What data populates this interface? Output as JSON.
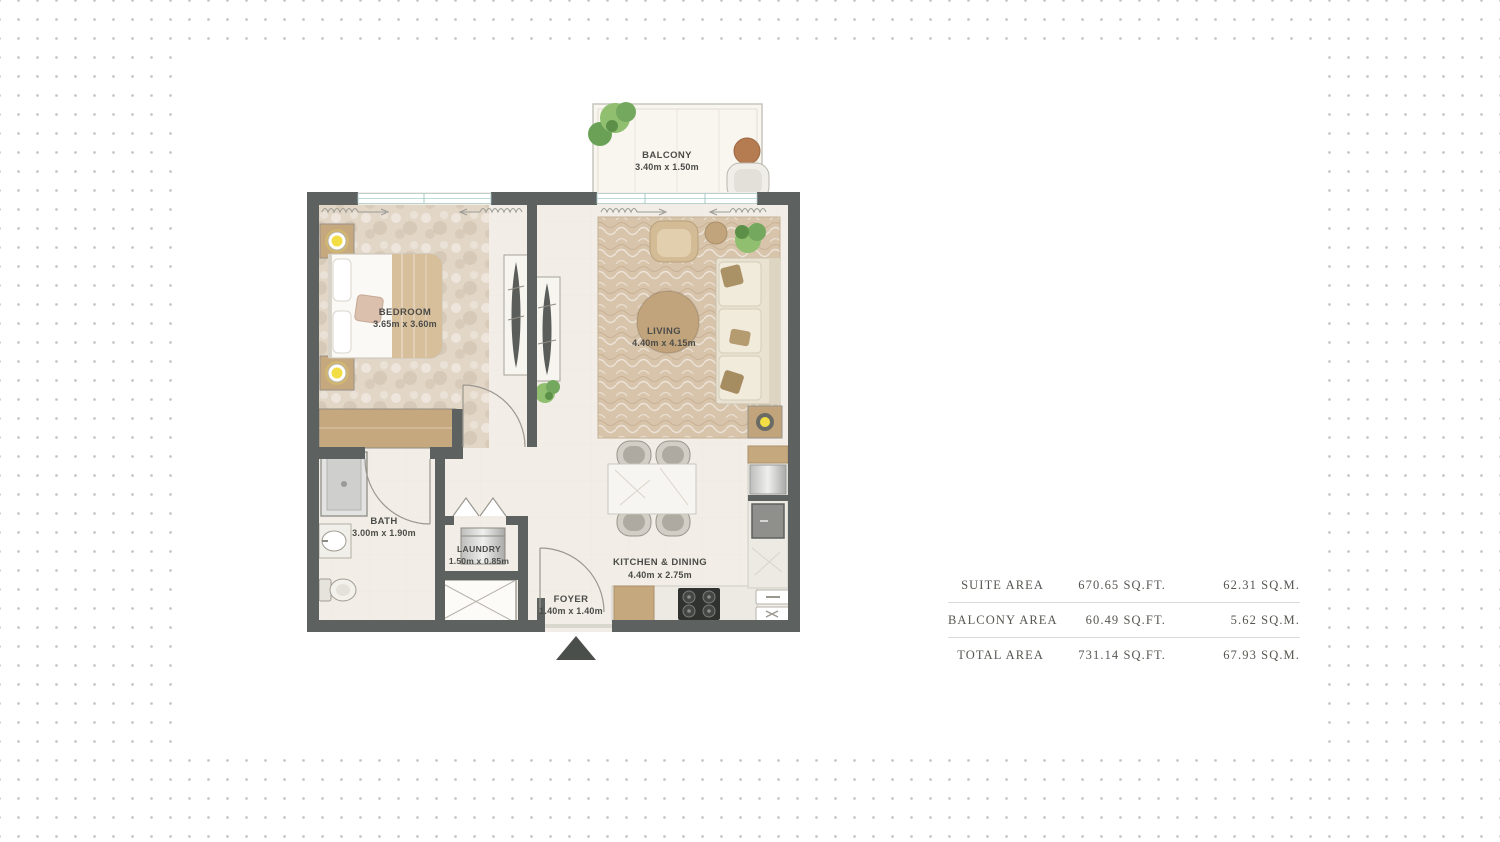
{
  "floorplan": {
    "rooms": [
      {
        "name": "BALCONY",
        "dims": "3.40m x 1.50m"
      },
      {
        "name": "BEDROOM",
        "dims": "3.65m x 3.60m"
      },
      {
        "name": "LIVING",
        "dims": "4.40m x 4.15m"
      },
      {
        "name": "BATH",
        "dims": "3.00m x 1.90m"
      },
      {
        "name": "LAUNDRY",
        "dims": "1.50m x 0.85m"
      },
      {
        "name": "KITCHEN & DINING",
        "dims": "4.40m x 2.75m"
      },
      {
        "name": "FOYER",
        "dims": "1.40m x 1.40m"
      }
    ],
    "colors": {
      "wall": "#5d615f",
      "floor": "#f2eee7",
      "rug_living": "#d7c4ab",
      "rug_bedroom": "#e2d6c6",
      "wood_tan": "#c6a87f",
      "sofa_cream": "#e9e2d1",
      "plant_green": "#74a85e",
      "lamp_yellow": "#f2de44",
      "window_glass": "#bcdcd8",
      "dot_grid": "#c7c7c7",
      "label_text": "#4b4b48"
    }
  },
  "area_table": {
    "rows": [
      {
        "label": "SUITE AREA",
        "sqft": "670.65 SQ.FT.",
        "sqm": "62.31 SQ.M."
      },
      {
        "label": "BALCONY AREA",
        "sqft": "60.49 SQ.FT.",
        "sqm": "5.62 SQ.M."
      },
      {
        "label": "TOTAL AREA",
        "sqft": "731.14 SQ.FT.",
        "sqm": "67.93 SQ.M."
      }
    ]
  }
}
